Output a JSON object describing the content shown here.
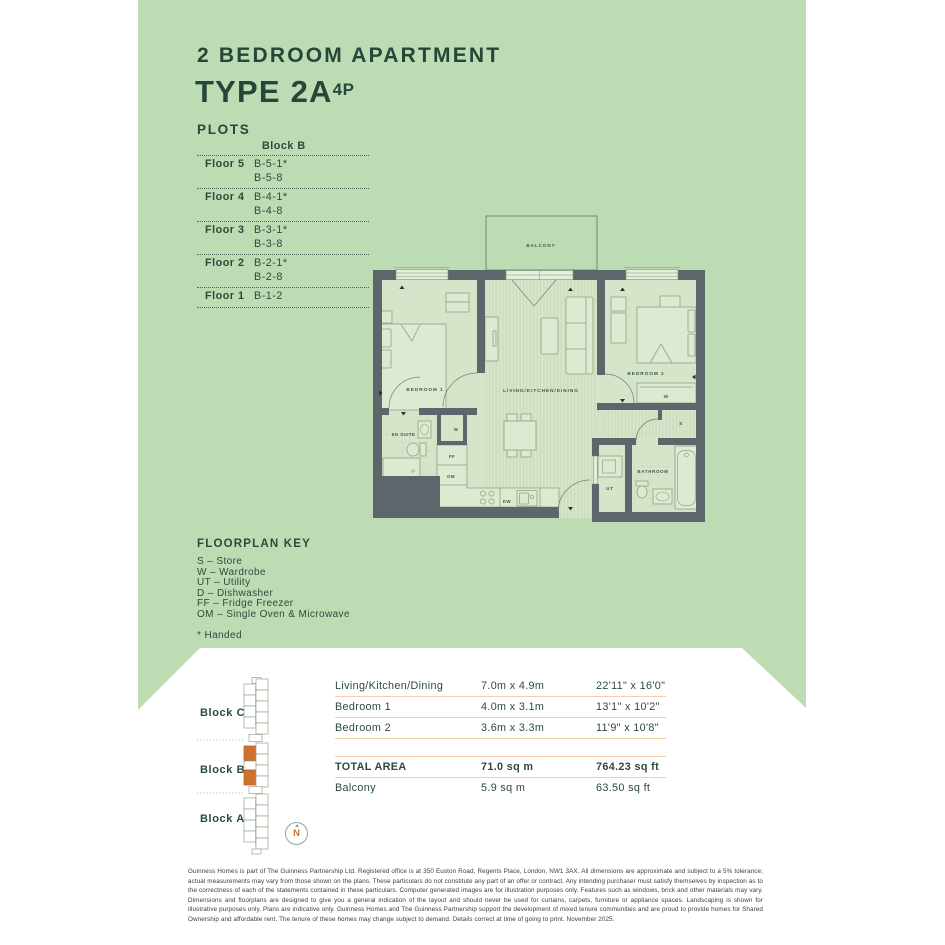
{
  "header": {
    "subtitle": "2 BEDROOM APARTMENT",
    "type_title": "TYPE 2A",
    "type_sup": "4P",
    "plots_heading": "PLOTS"
  },
  "plots_table": {
    "column_header": "Block B",
    "rows": [
      {
        "floor": "Floor 5",
        "line1": "B-5-1*",
        "line2": "B-5-8"
      },
      {
        "floor": "Floor 4",
        "line1": "B-4-1*",
        "line2": "B-4-8"
      },
      {
        "floor": "Floor 3",
        "line1": "B-3-1*",
        "line2": "B-3-8"
      },
      {
        "floor": "Floor 2",
        "line1": "B-2-1*",
        "line2": "B-2-8"
      },
      {
        "floor": "Floor 1",
        "line1": "B-1-2",
        "line2": ""
      }
    ]
  },
  "floorplan": {
    "labels": {
      "balcony": "BALCONY",
      "bedroom1": "BEDROOM 1",
      "living": "LIVING/KITCHEN/DINING",
      "bedroom2": "BEDROOM 2",
      "ensuite": "EN SUITE",
      "bathroom": "BATHROOM",
      "utility": "UT",
      "wardrobe1": "W",
      "wardrobe2": "W",
      "store": "S",
      "fridge_freezer": "FF",
      "oven_microwave": "OM",
      "dishwasher": "DW"
    }
  },
  "key": {
    "heading": "FLOORPLAN KEY",
    "items": [
      "S – Store",
      "W – Wardrobe",
      "UT – Utility",
      "D – Dishwasher",
      "FF – Fridge Freezer",
      "OM – Single Oven & Microwave"
    ],
    "footnote": "* Handed"
  },
  "site_plan": {
    "blocks": [
      "Block C",
      "Block B",
      "Block A"
    ],
    "north": "N"
  },
  "dimensions": {
    "rows": [
      {
        "name": "Living/Kitchen/Dining",
        "metric": "7.0m x 4.9m",
        "imperial": "22'11\" x 16'0\""
      },
      {
        "name": "Bedroom 1",
        "metric": "4.0m x 3.1m",
        "imperial": "13'1\" x 10'2\""
      },
      {
        "name": "Bedroom 2",
        "metric": "3.6m x 3.3m",
        "imperial": "11'9\" x 10'8\""
      }
    ],
    "total": {
      "name": "TOTAL AREA",
      "metric": "71.0 sq m",
      "imperial": "764.23 sq ft"
    },
    "balcony": {
      "name": "Balcony",
      "metric": "5.9 sq m",
      "imperial": "63.50 sq ft"
    }
  },
  "disclaimer": "Guinness Homes is part of The Guinness Partnership Ltd. Registered office is at 350 Euston Road, Regents Place, London, NW1 3AX. All dimensions are approximate and subject to a 5% tolerance; actual measurements may vary from those shown on the plans. These particulars do not constitute any part of an offer or contract. Any intending purchaser must satisfy themselves by inspection as to the correctness of each of the statements contained in these particulars. Computer generated images are for illustration purposes only. Features such as windows, brick and other materials may vary. Dimensions and floorplans are designed to give you a general indication of the layout and should never be used for curtains, carpets, furniture or appliance spaces. Landscaping is shown for illustrative purposes only. Plans are indicative only. Guinness Homes and The Guinness Partnership support the development of mixed tenure communities and are proud to provide homes for Shared Ownership and affordable rent. The tenure of these homes may change subject to demand. Details correct at time of going to print. November 2025.",
  "colors": {
    "background_green": "#bedcb4",
    "wall": "#5c666b",
    "accent_orange": "#d0702e",
    "table_rule": "#f4cfa8",
    "text_green": "#2b4a3c"
  }
}
